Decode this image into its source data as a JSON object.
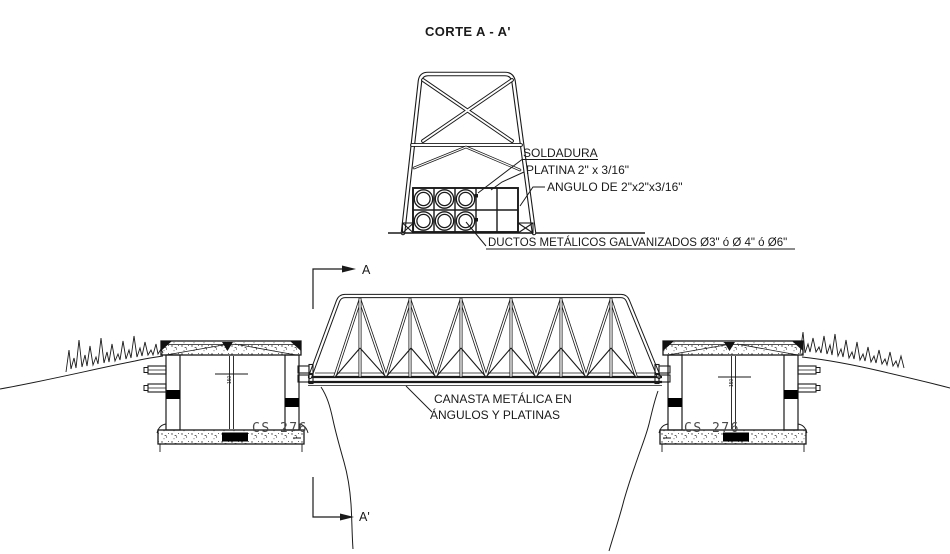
{
  "title": "CORTE A - A'",
  "cross_section": {
    "soldadura": "SOLDADURA",
    "platina": "PLATINA 2\" x 3/16\"",
    "angulo": "ANGULO DE 2\"x2\"x3/16\"",
    "ductos": "DUCTOS METÁLICOS GALVANIZADOS Ø3\" ó Ø 4\" ó Ø6\""
  },
  "elevation": {
    "canasta_line1": "CANASTA METÁLICA EN",
    "canasta_line2": "ÁNGULOS Y PLATINAS",
    "section_marker_top": "A",
    "section_marker_bottom": "A'",
    "left_chamber": {
      "label": "CS 276",
      "dim": "150"
    },
    "right_chamber": {
      "label": "CS 276",
      "dim": "150"
    }
  },
  "colors": {
    "line": "#1a1a1a",
    "chamber_label": "#4a4a4a",
    "background": "#ffffff"
  }
}
